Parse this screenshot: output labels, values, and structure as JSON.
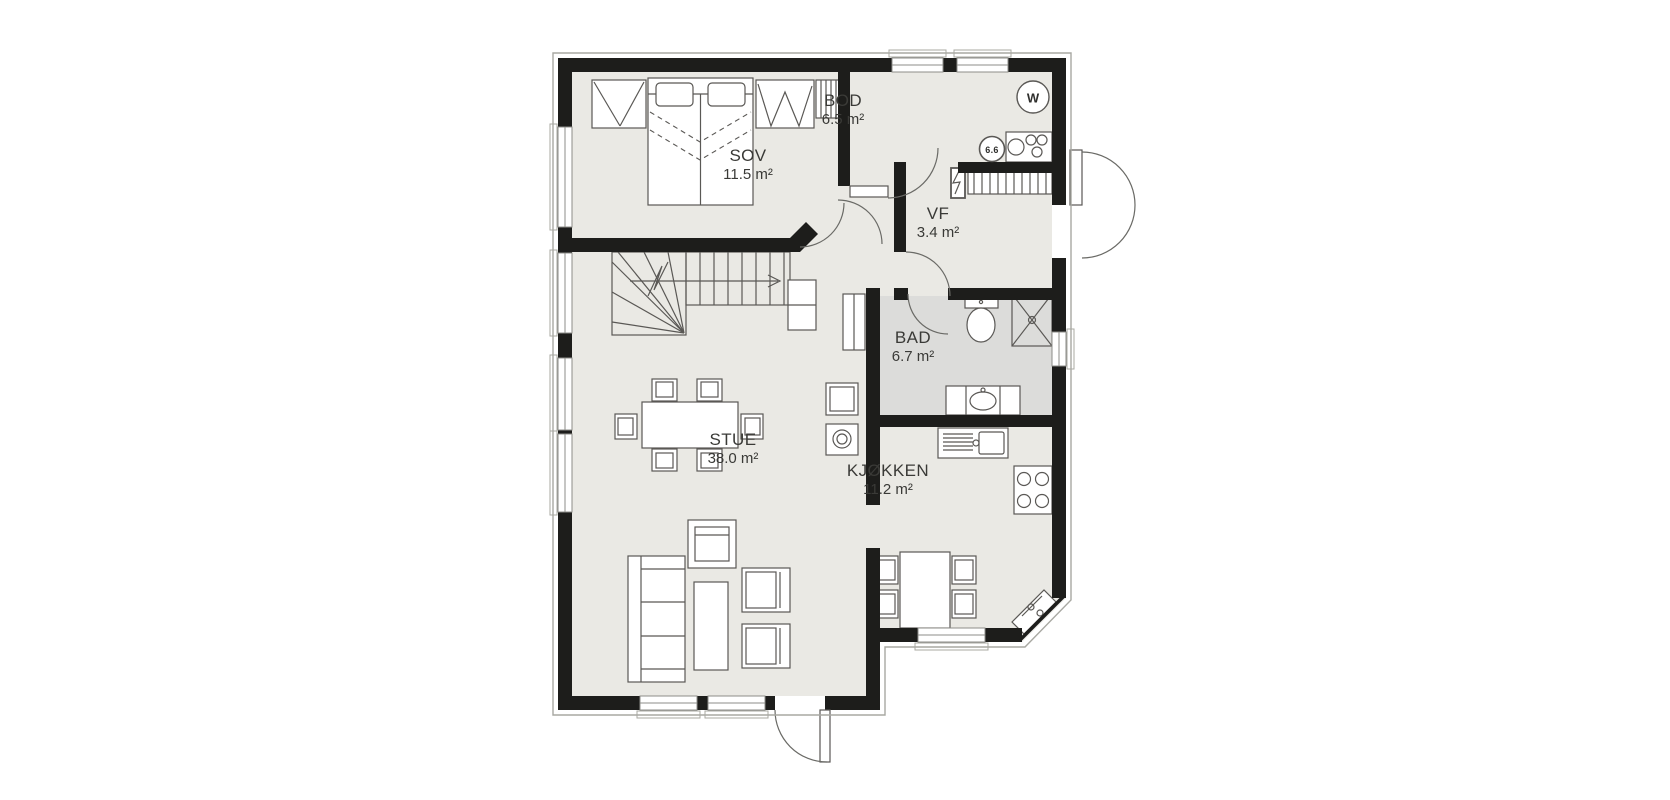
{
  "rooms": [
    {
      "name": "SOV",
      "area": "11.5 m²"
    },
    {
      "name": "BOD",
      "area": "6.5 m²"
    },
    {
      "name": "VF",
      "area": "3.4 m²"
    },
    {
      "name": "BAD",
      "area": "6.7 m²"
    },
    {
      "name": "STUE",
      "area": "38.0 m²"
    },
    {
      "name": "KJØKKEN",
      "area": "11.2 m²"
    }
  ],
  "markers": {
    "water_heater": "W",
    "cabinet_label": "6.6"
  },
  "colors": {
    "wall": "#1d1d1b",
    "floor": "#eae9e4",
    "bath_floor": "#dcdcda",
    "furniture_line": "#5a5855",
    "background": "#ffffff"
  }
}
